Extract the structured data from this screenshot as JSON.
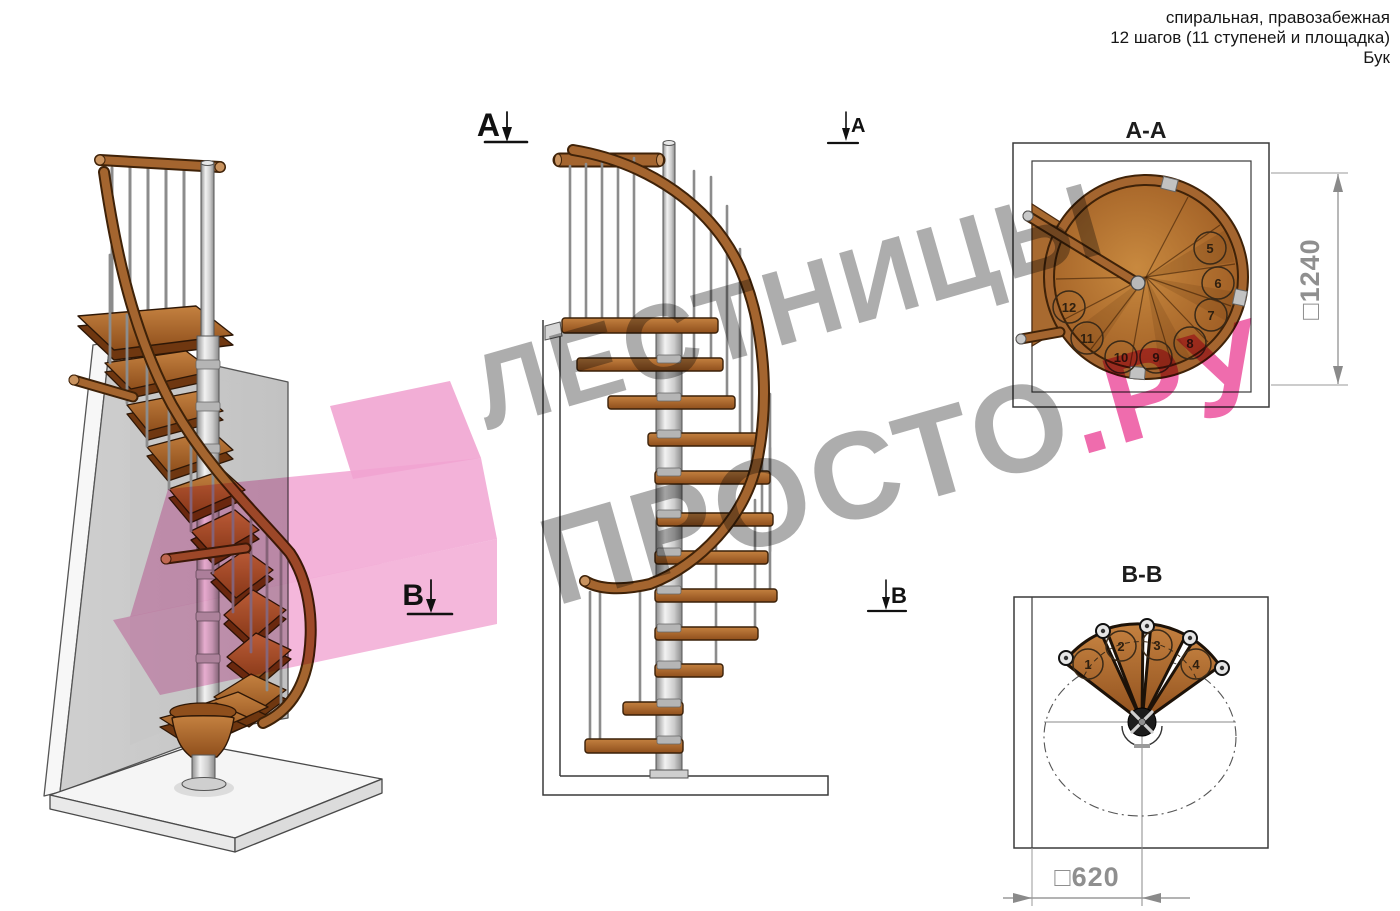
{
  "header": {
    "line1": "спиральная, правозабежная",
    "line2": "12 шагов (11 ступеней и площадка)",
    "line3": "Бук"
  },
  "markers": {
    "section_a": "A",
    "section_b": "B"
  },
  "sections": {
    "aa": {
      "title": "A-A",
      "dimension": "□1240",
      "steps": [
        "5",
        "6",
        "7",
        "8",
        "9",
        "10",
        "11",
        "12"
      ]
    },
    "bb": {
      "title": "B-B",
      "dimension": "□620",
      "steps": [
        "1",
        "2",
        "3",
        "4"
      ]
    }
  },
  "watermark": {
    "word1": "ЛЕСТНИЦЫ",
    "word2": "ПРОСТО",
    "word3": ".РУ",
    "gray": "#a6a6a6",
    "pink": "#ee5fa6",
    "shape_pink": "#f1a5d2"
  },
  "colors": {
    "wood": "#a4652f",
    "wood_dark": "#6f3710",
    "metal": "#c9c9c9",
    "wall": "#d2d2d2",
    "outline": "#2f2f2f",
    "dimension_gray": "#8f8f8f"
  }
}
